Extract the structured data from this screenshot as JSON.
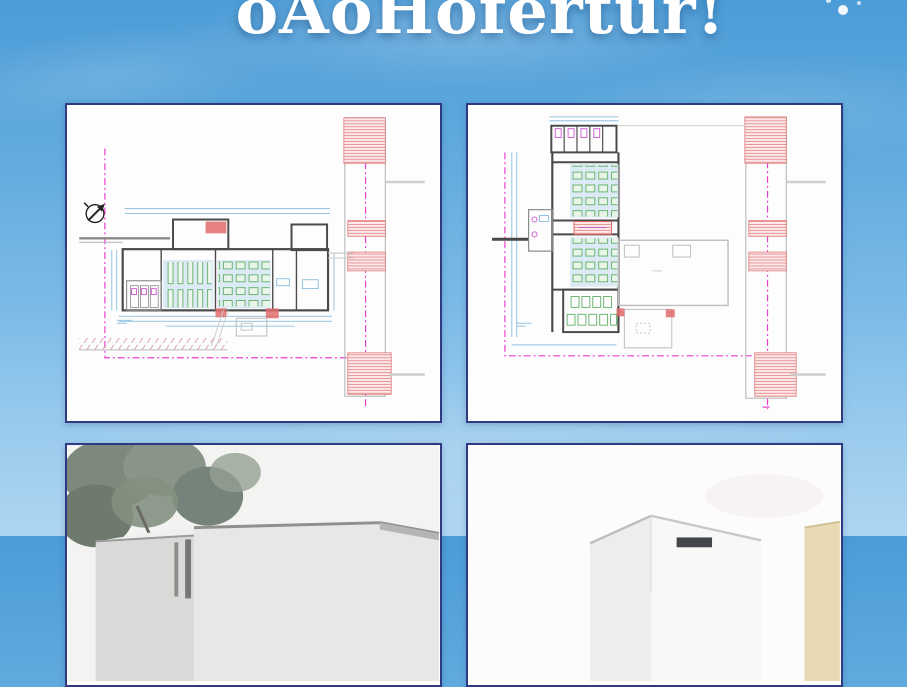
{
  "poster": {
    "clipped_title": "oAoHofertur!"
  },
  "theme": {
    "sky_top": "#4c9cd7",
    "sky_bottom": "#aed6f2",
    "title_color": "#ffffff",
    "paper": "#fdfdfd",
    "panel_border": "#2f3a80",
    "wall": "#4a4a4a",
    "dim": "#7ab4dc",
    "room": "#dceaf5",
    "desk_green": "#5fae64",
    "desk_fill": "#e8f5e8",
    "hatch_red_line": "#e07070",
    "hatch_red_fill": "#fceaea",
    "boundary_magenta": "#e83ed0",
    "fixture_magenta": "#cc55cc",
    "existing_gray": "#bdbdbd",
    "door_red": "#e06b6b"
  },
  "panels": [
    {
      "name": "floor-plan-drawing-left"
    },
    {
      "name": "floor-plan-drawing-right"
    },
    {
      "name": "exterior-render-left"
    },
    {
      "name": "exterior-render-right"
    }
  ]
}
